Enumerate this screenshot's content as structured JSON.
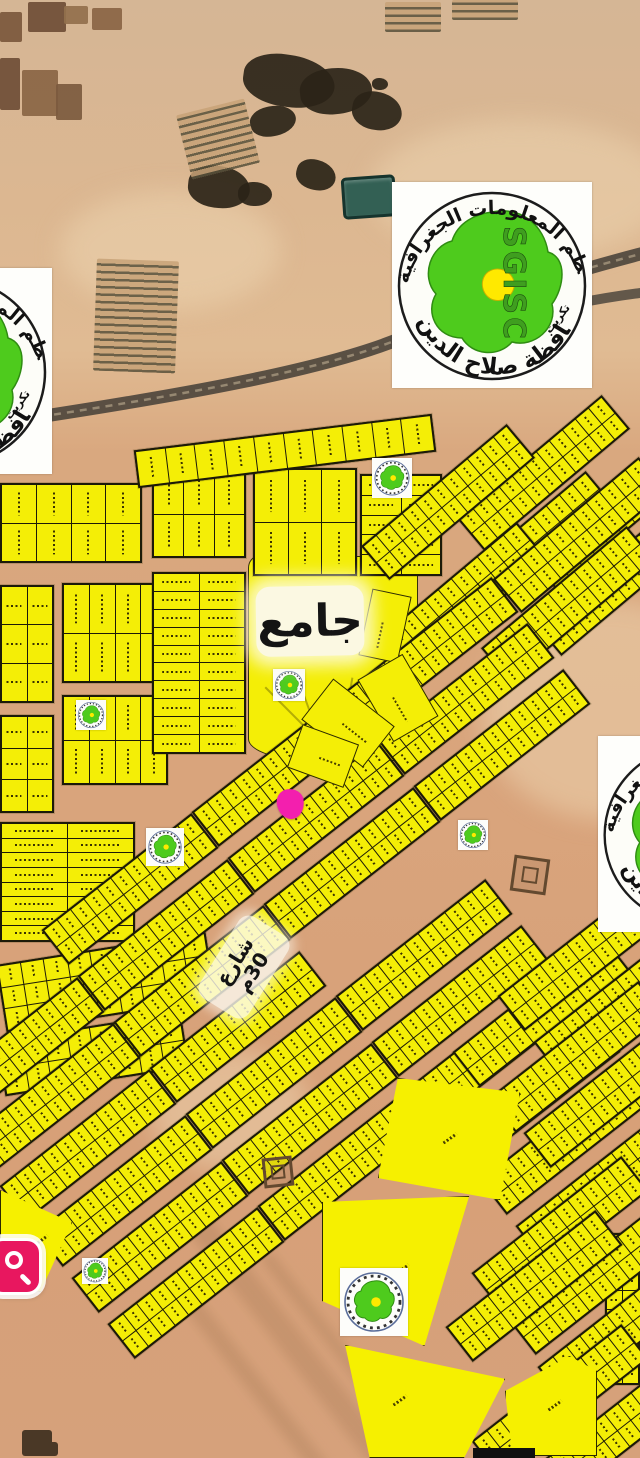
{
  "labels": {
    "mosque": "جامع",
    "street_line1": "شارع",
    "street_line2": "30م"
  },
  "logo": {
    "acronym": "SGISC",
    "arc_top": "نظم المعلومات الجغرافية",
    "arc_bottom": "محافظة صلاح الدين",
    "city": "تكريت",
    "green": "#4ecb1d",
    "district_yellow": "#ffe900",
    "ring_color": "#1c1c1c"
  },
  "colors": {
    "lot_yellow": "#f4ee06",
    "parcel_border": "#1c1a08",
    "marker_pink": "#f31fae",
    "search_pink": "#e8175f",
    "desert": "#d9a87f",
    "road_dark": "#4e463d"
  },
  "logos_large": [
    [
      392,
      182,
      200
    ],
    [
      -148,
      268,
      200
    ],
    [
      598,
      736,
      190
    ]
  ],
  "logos_mini": [
    [
      372,
      458,
      40
    ],
    [
      273,
      669,
      32
    ],
    [
      76,
      700,
      30
    ],
    [
      146,
      828,
      38
    ],
    [
      458,
      820,
      30
    ],
    [
      82,
      1258,
      26
    ],
    [
      340,
      1268,
      68
    ]
  ],
  "satellite": {
    "farms": [
      [
        0,
        12,
        22,
        30
      ],
      [
        28,
        2,
        38,
        30
      ],
      [
        0,
        58,
        20,
        52
      ],
      [
        22,
        70,
        36,
        46
      ],
      [
        56,
        84,
        26,
        36
      ],
      [
        92,
        8,
        30,
        22
      ],
      [
        64,
        6,
        24,
        18
      ]
    ],
    "farm_colors": [
      "#7b583c",
      "#6f4e36",
      "#6f4e36",
      "#8a6544",
      "#7c5a3e",
      "#8a6544",
      "#93704c"
    ],
    "dark_patches": [
      [
        243,
        55,
        92,
        52,
        8
      ],
      [
        300,
        68,
        72,
        46,
        -6
      ],
      [
        352,
        92,
        50,
        38,
        10
      ],
      [
        250,
        106,
        46,
        30,
        -12
      ],
      [
        188,
        166,
        62,
        42,
        6
      ],
      [
        238,
        182,
        34,
        24,
        0
      ],
      [
        296,
        160,
        40,
        30,
        14
      ],
      [
        372,
        78,
        16,
        12,
        0
      ]
    ],
    "stripe_fields": [
      [
        183,
        106,
        70,
        66,
        -14
      ],
      [
        95,
        260,
        82,
        112,
        2
      ],
      [
        385,
        2,
        56,
        30,
        0
      ],
      [
        452,
        0,
        66,
        20,
        0
      ]
    ],
    "pond": [
      342,
      176,
      54,
      42
    ],
    "light_patches": [
      [
        370,
        120,
        300,
        140
      ],
      [
        60,
        190,
        220,
        120
      ],
      [
        480,
        600,
        260,
        220
      ],
      [
        150,
        1050,
        160,
        120
      ]
    ],
    "wadi_streaks": [
      [
        300,
        1180,
        26,
        380
      ],
      [
        360,
        1220,
        14,
        330
      ],
      [
        250,
        1260,
        18,
        260
      ]
    ]
  },
  "parcels": {
    "axis_blocks": [
      [
        0,
        483,
        142,
        80,
        2,
        4,
        "v",
        0
      ],
      [
        152,
        470,
        94,
        88,
        2,
        3,
        "v",
        0
      ],
      [
        0,
        585,
        54,
        118,
        3,
        2,
        "h",
        0
      ],
      [
        62,
        583,
        106,
        100,
        2,
        4,
        "v",
        0
      ],
      [
        0,
        715,
        54,
        98,
        3,
        2,
        "h",
        0
      ],
      [
        62,
        695,
        106,
        90,
        2,
        4,
        "v",
        0
      ],
      [
        152,
        572,
        94,
        182,
        10,
        2,
        "h",
        0
      ],
      [
        0,
        822,
        135,
        120,
        8,
        2,
        "h",
        0
      ],
      [
        253,
        468,
        104,
        108,
        2,
        3,
        "v",
        0
      ],
      [
        360,
        474,
        82,
        102,
        5,
        2,
        "h",
        0
      ],
      [
        135,
        432,
        300,
        38,
        1,
        10,
        "v",
        -7
      ],
      [
        0,
        948,
        212,
        68,
        3,
        9,
        "v",
        -9
      ],
      [
        0,
        1026,
        186,
        56,
        2,
        8,
        "v",
        -9
      ],
      [
        605,
        1233,
        35,
        152,
        8,
        2,
        "h",
        0
      ]
    ],
    "strips": {
      "w": 190,
      "h": 44,
      "rot": -38,
      "rows": 2,
      "cols": 11,
      "centers": [
        [
          543,
          473,
          -40
        ],
        [
          448,
          502,
          -40
        ],
        [
          527,
          549,
          -40
        ],
        [
          615,
          512,
          -40
        ],
        [
          620,
          578,
          -40
        ],
        [
          568,
          604,
          -40
        ],
        [
          458,
          600,
          -40
        ],
        [
          580,
          535,
          -40
        ],
        [
          430,
          653
        ],
        [
          466,
          699
        ],
        [
          502,
          745
        ],
        [
          280,
          771
        ],
        [
          316,
          817
        ],
        [
          352,
          863
        ],
        [
          130,
          889
        ],
        [
          166,
          935
        ],
        [
          202,
          981
        ],
        [
          238,
          1027
        ],
        [
          274,
          1073
        ],
        [
          310,
          1119
        ],
        [
          346,
          1165
        ],
        [
          424,
          955
        ],
        [
          460,
          1001
        ],
        [
          496,
          1047
        ],
        [
          532,
          1093
        ],
        [
          568,
          1139
        ],
        [
          604,
          1185
        ],
        [
          16,
          1053
        ],
        [
          52,
          1099
        ],
        [
          88,
          1145
        ],
        [
          124,
          1191
        ],
        [
          160,
          1237
        ],
        [
          196,
          1283
        ],
        [
          541,
          1011
        ],
        [
          586,
          955
        ],
        [
          622,
          1001
        ],
        [
          577,
          1057
        ],
        [
          612,
          1092
        ],
        [
          560,
          1232
        ],
        [
          597,
          1279
        ],
        [
          534,
          1286
        ],
        [
          626,
          1326
        ],
        [
          560,
          1400
        ],
        [
          597,
          1446
        ]
      ]
    },
    "big_parcels": [
      [
        322,
        1196,
        160,
        150,
        "polygon(0% 4%,92% 0%,64% 100%,0% 70%)"
      ],
      [
        300,
        1345,
        205,
        113,
        "polygon(22% 0%,100% 30%,80% 100%,34% 100%)"
      ],
      [
        505,
        1356,
        92,
        100,
        "polygon(0% 35%,70% 0%,100% 15%,100% 100%,8% 100%)"
      ],
      [
        0,
        1190,
        72,
        102,
        "polygon(0% 0%,100% 32%,56% 100%,0% 86%)"
      ],
      [
        378,
        1078,
        142,
        122,
        "polygon(14% 0%,100% 12%,86% 100%,0% 82%)"
      ]
    ],
    "wedges": [
      [
        365,
        592,
        40,
        68,
        12
      ],
      [
        372,
        662,
        52,
        72,
        -30
      ],
      [
        322,
        684,
        52,
        78,
        -52
      ],
      [
        300,
        726,
        46,
        60,
        -70
      ]
    ],
    "mosque_area": {
      "x": 248,
      "y": 556,
      "w": 170,
      "h": 205
    },
    "buildings": [
      [
        512,
        857,
        36,
        8
      ],
      [
        263,
        1157,
        30,
        -6
      ]
    ],
    "small_buildings": [
      [
        22,
        1430,
        30,
        26
      ],
      [
        40,
        1442,
        18,
        14
      ]
    ],
    "black_bar": [
      473,
      1448,
      62,
      10
    ]
  }
}
